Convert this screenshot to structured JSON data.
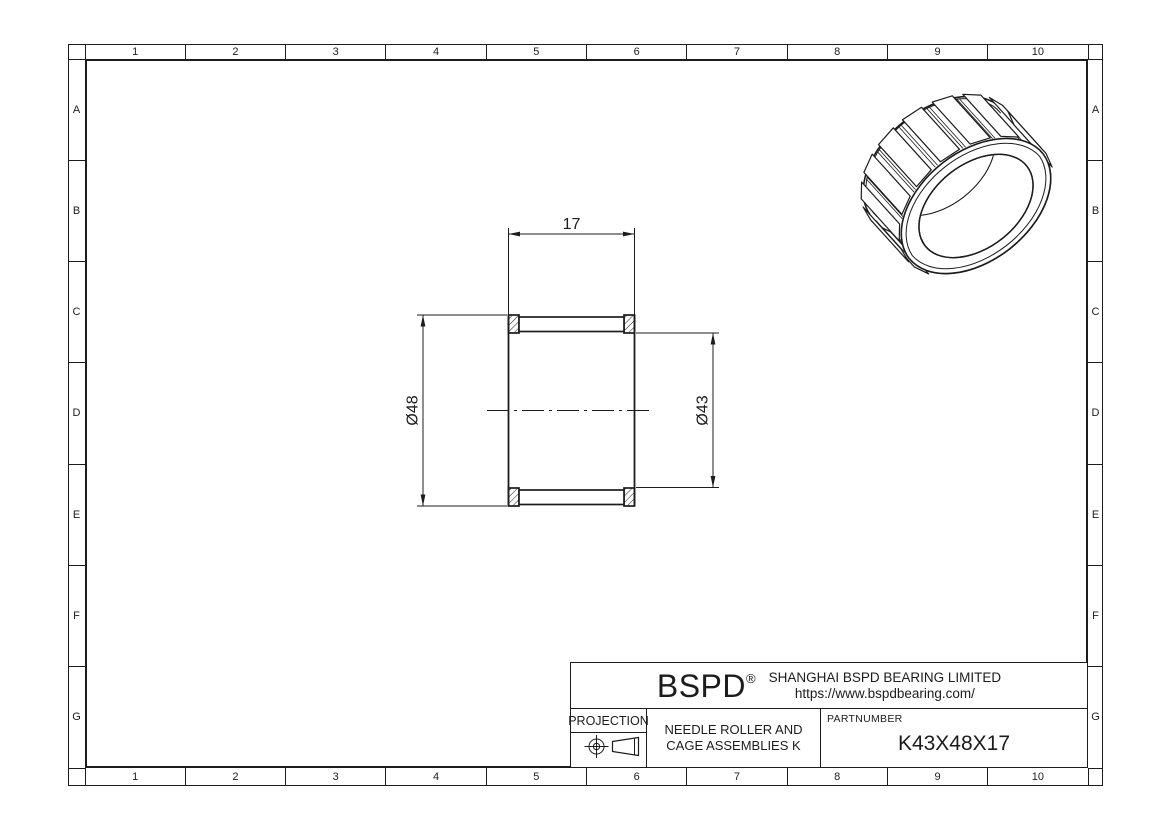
{
  "sheet": {
    "grid_columns": [
      "1",
      "2",
      "3",
      "4",
      "5",
      "6",
      "7",
      "8",
      "9",
      "10"
    ],
    "grid_rows": [
      "A",
      "B",
      "C",
      "D",
      "E",
      "F",
      "G"
    ]
  },
  "drawing": {
    "width_dim": "17",
    "outer_dia_dim": "Ø48",
    "inner_dia_dim": "Ø43"
  },
  "title_block": {
    "brand": "BSPD",
    "registered_mark": "®",
    "company": "SHANGHAI BSPD BEARING LIMITED",
    "website": "https://www.bspdbearing.com/",
    "projection_label": "PROJECTION",
    "description_line1": "NEEDLE ROLLER AND",
    "description_line2": "CAGE ASSEMBLIES K",
    "partnumber_label": "PARTNUMBER",
    "partnumber": "K43X48X17"
  },
  "colors": {
    "line": "#1c1c1c",
    "background": "#ffffff"
  }
}
